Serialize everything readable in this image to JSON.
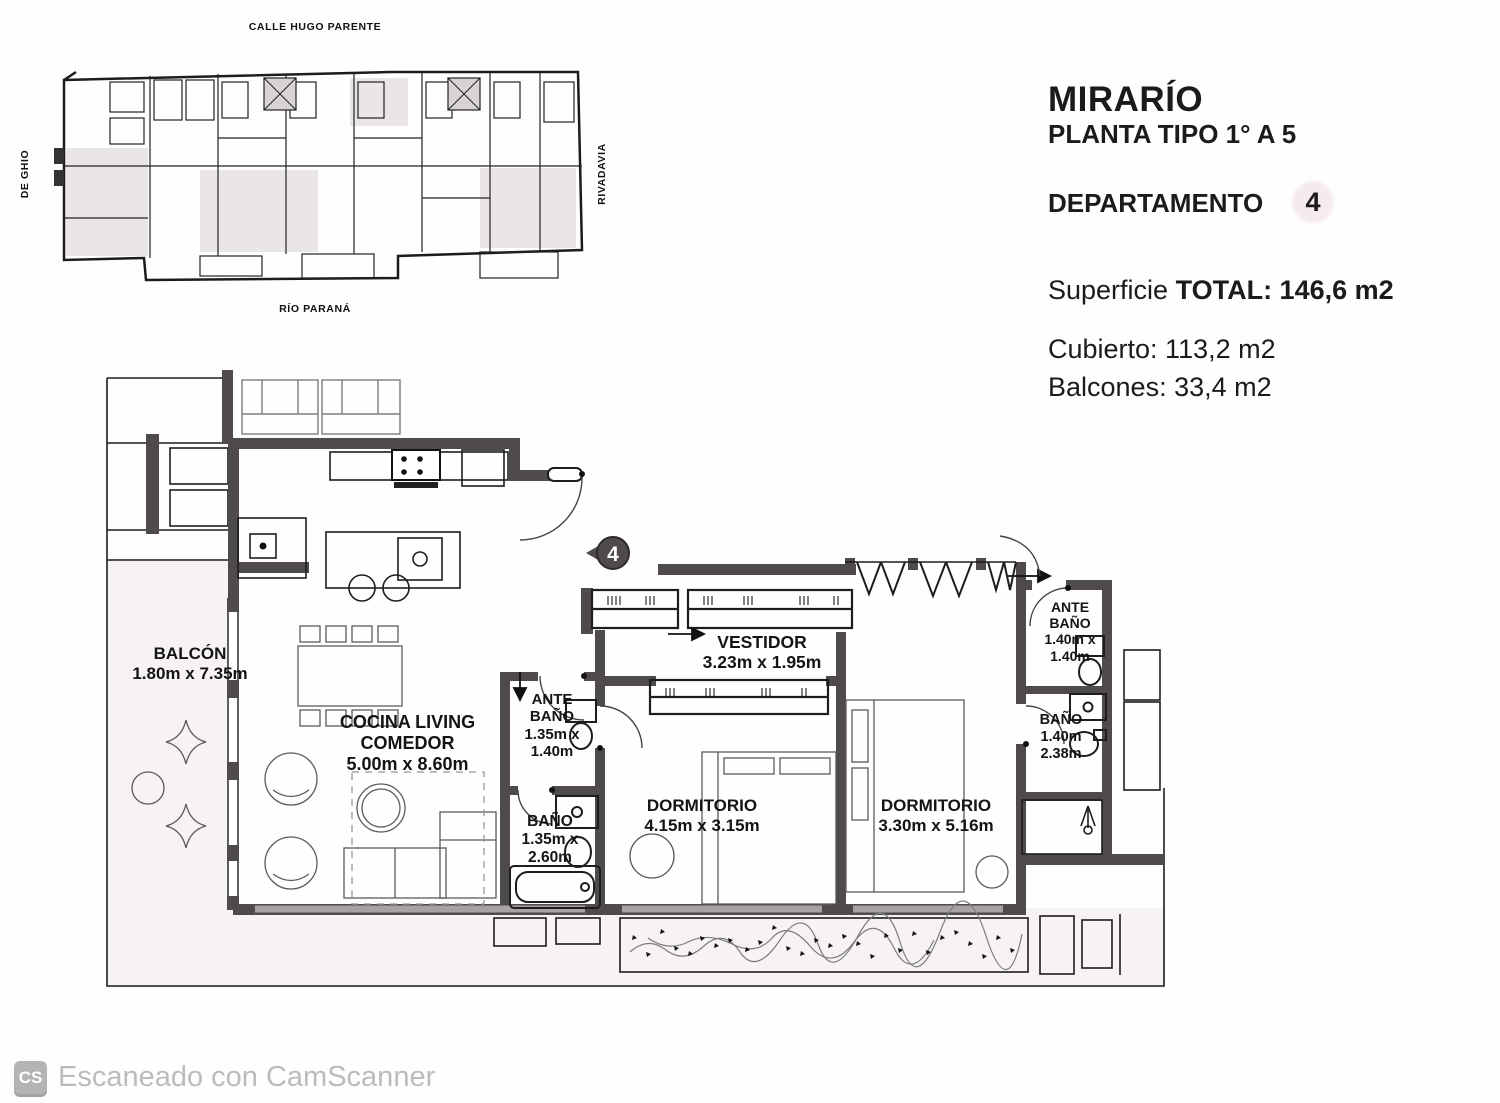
{
  "site_plan": {
    "streets": {
      "top": "CALLE HUGO PARENTE",
      "left": "DE GHIO",
      "right": "RIVADAVIA",
      "bottom": "RÍO PARANÁ"
    }
  },
  "title_block": {
    "project": "MIRARÍO",
    "floor": "PLANTA TIPO 1° A 5",
    "unit_label": "DEPARTAMENTO",
    "unit_number": "4",
    "area_prefix": "Superficie ",
    "area_total": "TOTAL: 146,6 m2",
    "covered": "Cubierto: 113,2 m2",
    "balconies": "Balcones: 33,4 m2"
  },
  "floor_plan": {
    "unit_marker": "4",
    "rooms": [
      {
        "id": "balcon",
        "line1": "BALCÓN",
        "line2": "1.80m x 7.35m"
      },
      {
        "id": "cocina",
        "line1": "COCINA LIVING",
        "line2": "COMEDOR",
        "line3": "5.00m x 8.60m"
      },
      {
        "id": "ante-bano-1",
        "line1": "ANTE",
        "line2": "BAÑO",
        "line3": "1.35m x",
        "line4": "1.40m"
      },
      {
        "id": "bano-1",
        "line1": "BAÑO",
        "line2": "1.35m x",
        "line3": "2.60m"
      },
      {
        "id": "vestidor",
        "line1": "VESTIDOR",
        "line2": "3.23m x 1.95m"
      },
      {
        "id": "dormitorio-1",
        "line1": "DORMITORIO",
        "line2": "4.15m x 3.15m"
      },
      {
        "id": "dormitorio-2",
        "line1": "DORMITORIO",
        "line2": "3.30m x 5.16m"
      },
      {
        "id": "ante-bano-2",
        "line1": "ANTE",
        "line2": "BAÑO",
        "line3": "1.40m x",
        "line4": "1.40m"
      },
      {
        "id": "bano-2",
        "line1": "BAÑO",
        "line2": "1.40m",
        "line3": "2.38m"
      }
    ]
  },
  "watermark": {
    "logo": "CS",
    "text": "Escaneado con CamScanner"
  },
  "colors": {
    "wall_gray": "#4f4b4d",
    "scan_tint": "#f7f3f4",
    "watermark_gray": "#bcbcbc"
  }
}
